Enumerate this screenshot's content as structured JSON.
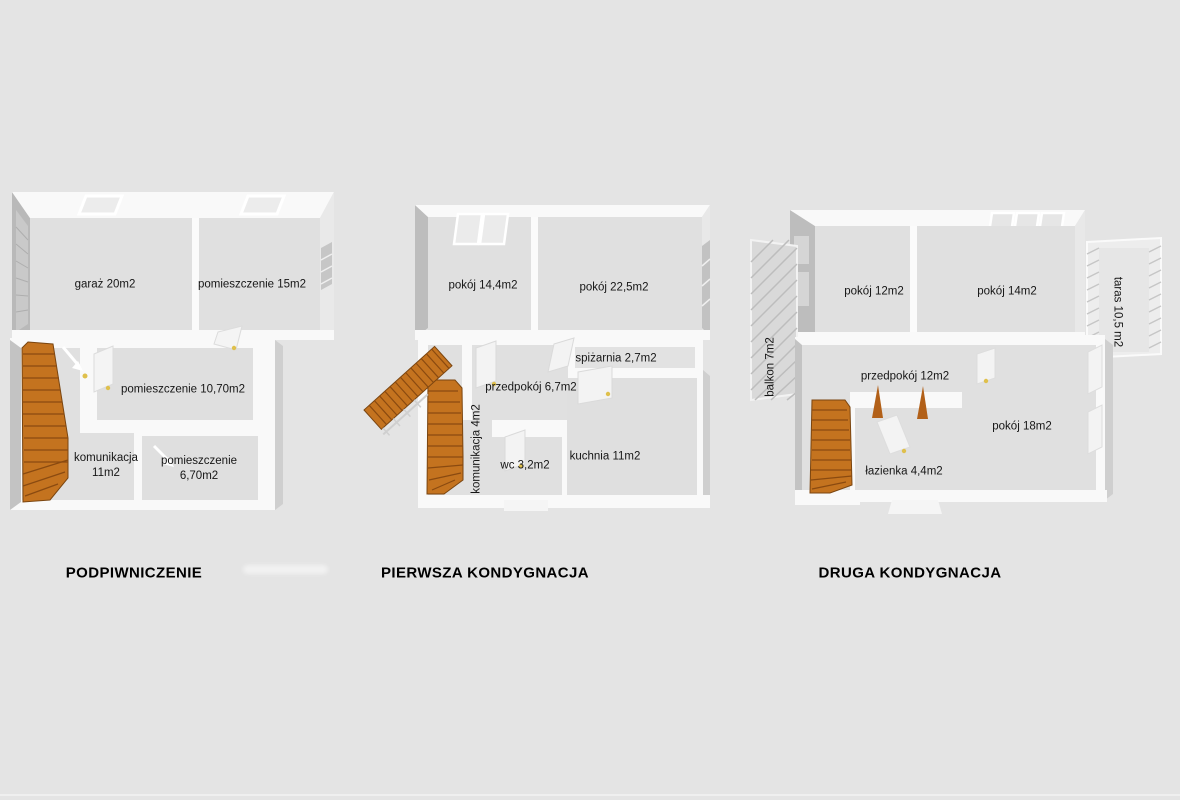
{
  "colors": {
    "background": "#e4e4e4",
    "floor": "#e0e0e0",
    "wall": "#f9f9f9",
    "wall_shadow": "#bdbdbd",
    "stairs_accent": "#c4731f",
    "label_text": "#161616",
    "title_text": "#000000"
  },
  "plans": [
    {
      "title": "PODPIWNICZENIE",
      "rooms": [
        {
          "line1": "garaż 20m2"
        },
        {
          "line1": "pomieszczenie 15m2"
        },
        {
          "line1": "pomieszczenie 10,70m2"
        },
        {
          "line1": "komunikacja",
          "line2": "11m2"
        },
        {
          "line1": "pomieszczenie",
          "line2": "6,70m2"
        }
      ]
    },
    {
      "title": "PIERWSZA KONDYGNACJA",
      "rooms": [
        {
          "line1": "pokój 14,4m2"
        },
        {
          "line1": "pokój 22,5m2"
        },
        {
          "line1": "spiżarnia 2,7m2"
        },
        {
          "line1": "przedpokój 6,7m2"
        },
        {
          "line1": "komunikacja 4m2"
        },
        {
          "line1": "wc 3,2m2"
        },
        {
          "line1": "kuchnia 11m2"
        }
      ]
    },
    {
      "title": "DRUGA KONDYGNACJA",
      "rooms": [
        {
          "line1": "pokój 12m2"
        },
        {
          "line1": "pokój 14m2"
        },
        {
          "line1": "balkon 7m2"
        },
        {
          "line1": "taras 10,5 m2"
        },
        {
          "line1": "przedpokój 12m2"
        },
        {
          "line1": "pokój 18m2"
        },
        {
          "line1": "łazienka 4,4m2"
        }
      ]
    }
  ]
}
